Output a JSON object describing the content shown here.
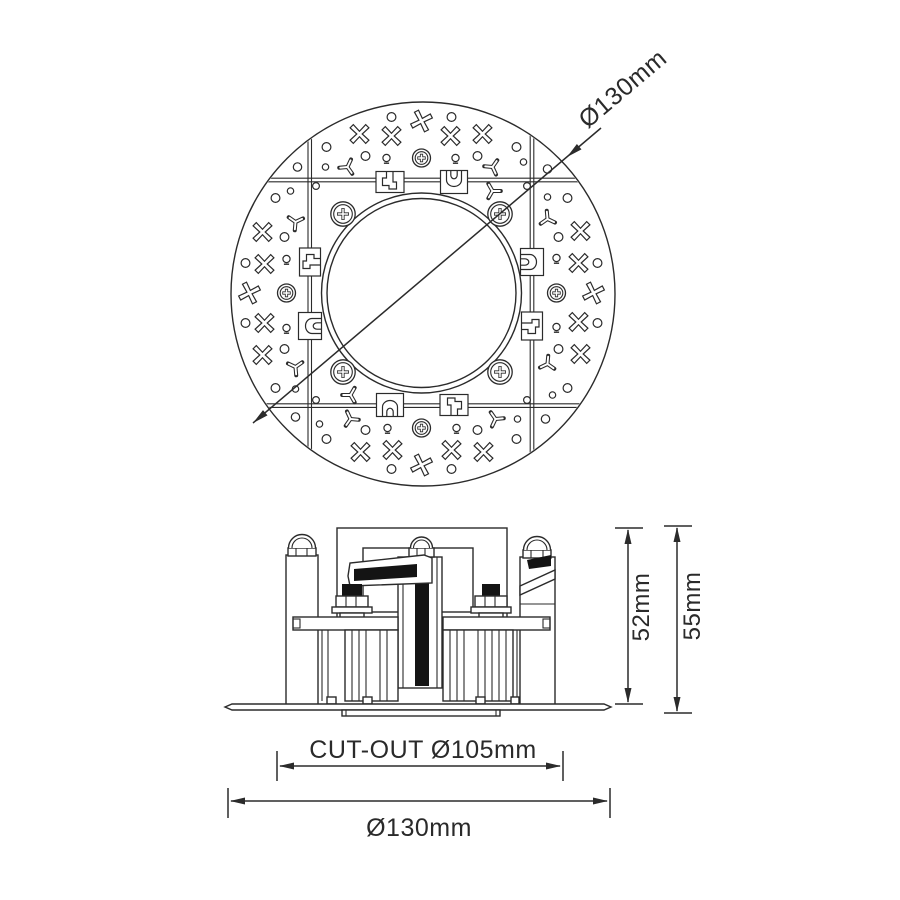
{
  "labels": {
    "top_view_diameter": "Ø130mm",
    "side_height_body": "52mm",
    "side_height_total": "55mm",
    "cutout_diameter": "CUT-OUT Ø105mm",
    "overall_diameter": "Ø130mm"
  },
  "colors": {
    "line": "#2b2b2b",
    "ink": "#141414",
    "background": "#ffffff"
  }
}
